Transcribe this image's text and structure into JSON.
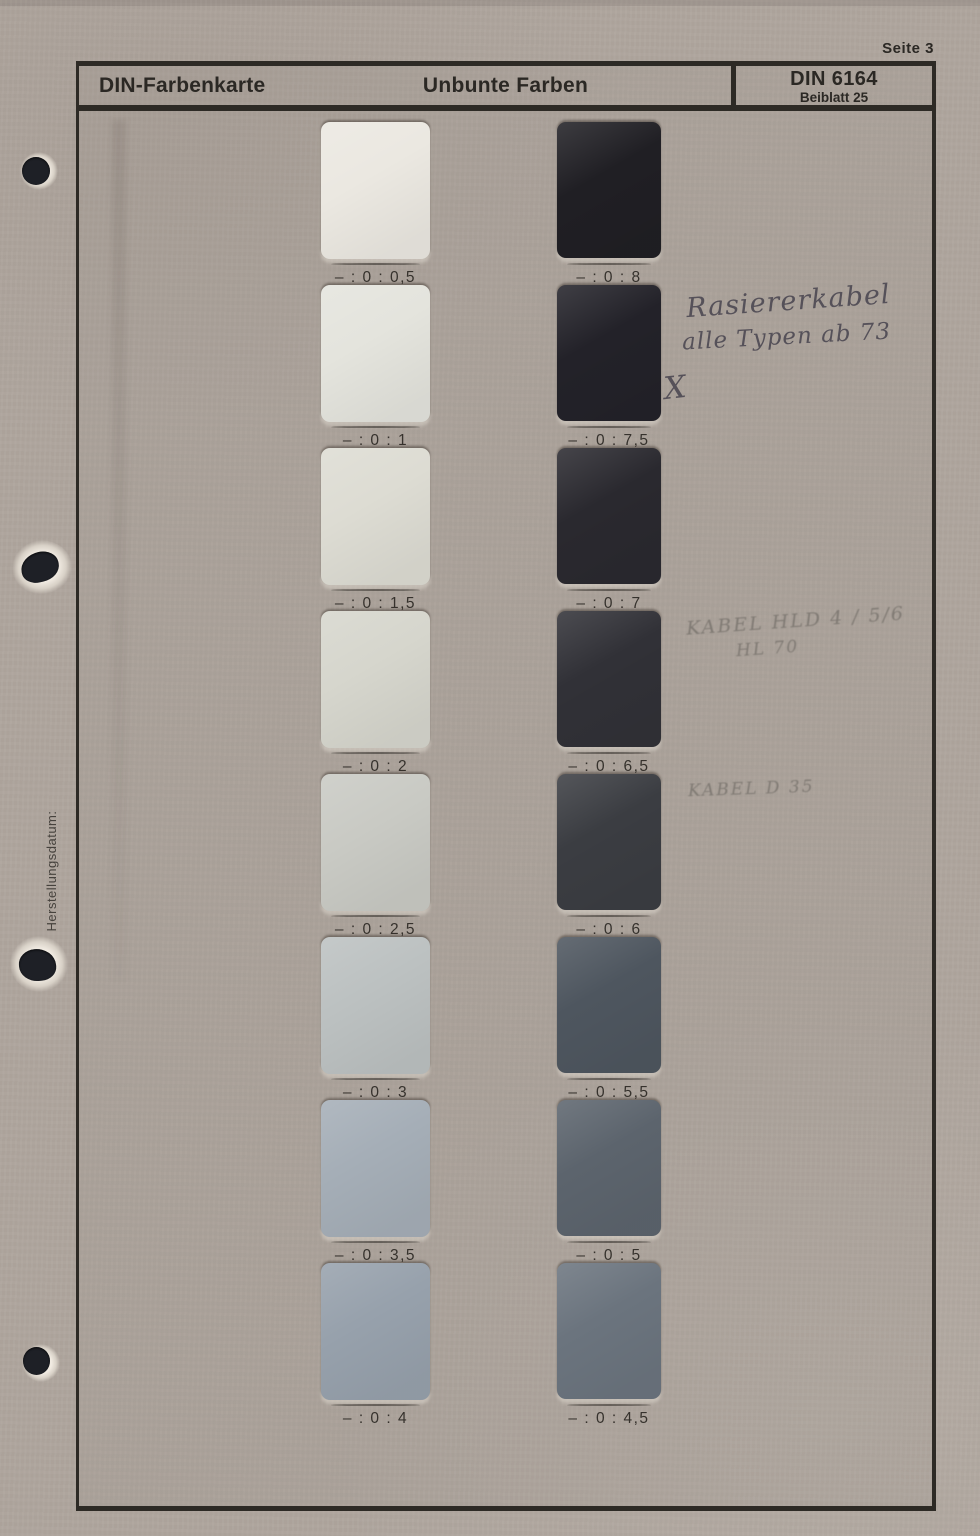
{
  "page": {
    "page_label": "Seite 3"
  },
  "header": {
    "title_left": "DIN-Farbenkarte",
    "title_center": "Unbunte Farben",
    "standard": "DIN 6164",
    "standard_sub": "Beiblatt 25"
  },
  "margin": {
    "vertical_label": "Herstellungsdatum:"
  },
  "handwritten_notes": {
    "note1_line1": "Rasiererkabel",
    "note1_line2": "alle Typen ab 73",
    "note1_mark": "X",
    "note2_line1": "KABEL HLD 4 / 5/6",
    "note2_line2": "HL 70",
    "note3": "KABEL D 35"
  },
  "colors": {
    "paper": "#afa69e",
    "frame": "#2d2a25",
    "ink": "#2b2824",
    "pencil_dark": "#4e4a54",
    "pencil_faint": "#767068",
    "hole": "#1e2026"
  },
  "swatch_columns": {
    "left": [
      {
        "label": "– : 0 : 0,5",
        "color": "#ebe8e1"
      },
      {
        "label": "– : 0 : 1",
        "color": "#e4e4dd"
      },
      {
        "label": "– : 0 : 1,5",
        "color": "#dddcd3"
      },
      {
        "label": "– : 0 : 2",
        "color": "#d6d6cd"
      },
      {
        "label": "– : 0 : 2,5",
        "color": "#c9cac4"
      },
      {
        "label": "– : 0 : 3",
        "color": "#bcc1c1"
      },
      {
        "label": "– : 0 : 3,5",
        "color": "#a5aeb7"
      },
      {
        "label": "– : 0 : 4",
        "color": "#97a1ac"
      }
    ],
    "right": [
      {
        "label": "– : 0 : 8",
        "color": "#201f24"
      },
      {
        "label": "– : 0 : 7,5",
        "color": "#232229"
      },
      {
        "label": "– : 0 : 7",
        "color": "#2a292f"
      },
      {
        "label": "– : 0 : 6,5",
        "color": "#313137"
      },
      {
        "label": "– : 0 : 6",
        "color": "#3b3d42"
      },
      {
        "label": "– : 0 : 5,5",
        "color": "#4e565f"
      },
      {
        "label": "– : 0 : 5",
        "color": "#5c646d"
      },
      {
        "label": "– : 0 : 4,5",
        "color": "#6b747e"
      }
    ]
  }
}
